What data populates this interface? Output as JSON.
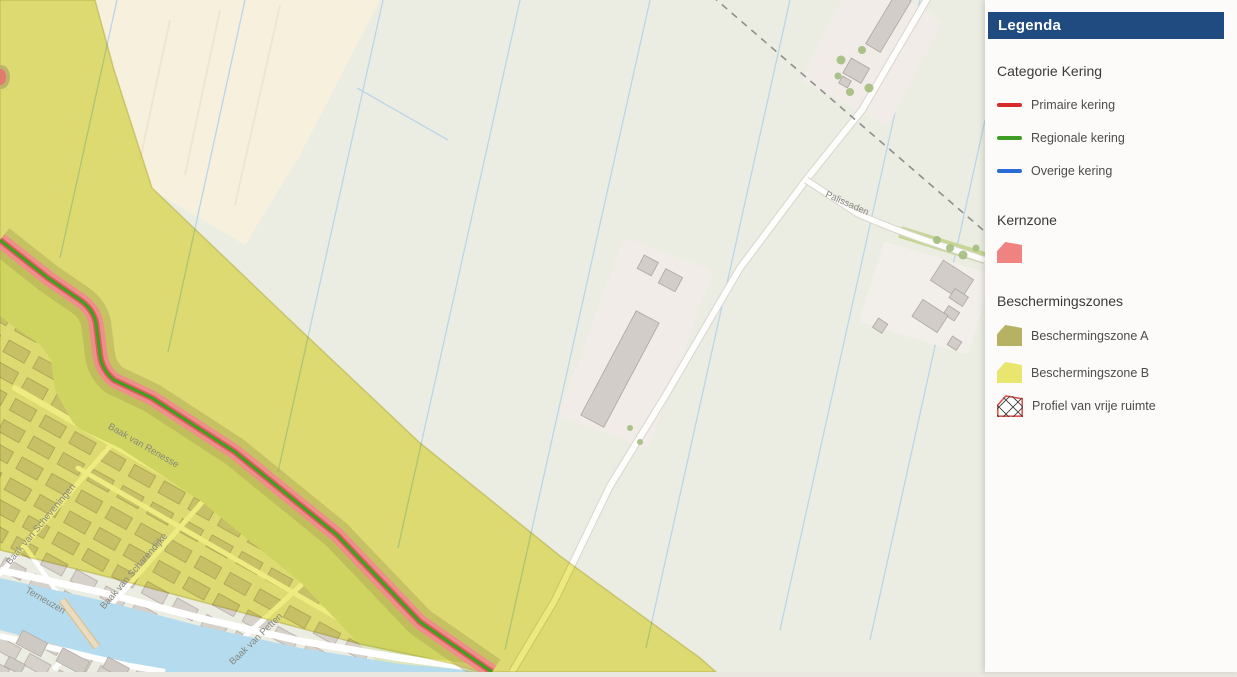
{
  "legend": {
    "title": "Legenda",
    "section_kering": {
      "heading": "Categorie Kering",
      "items": {
        "primaire": "Primaire kering",
        "regionale": "Regionale kering",
        "overige": "Overige kering"
      }
    },
    "section_kernzone": {
      "heading": "Kernzone"
    },
    "section_zones": {
      "heading": "Beschermingszones",
      "items": {
        "zone_a": "Beschermingszone A",
        "zone_b": "Beschermingszone B",
        "profiel": "Profiel van vrije ruimte"
      }
    }
  },
  "map": {
    "labels": {
      "palissaden": "Palissaden",
      "renesse": "Baak van Renesse",
      "scheveningen": "Baak van Scheveningen",
      "scharendijke": "Baak van Scharendijke",
      "petten": "Baak van Petten",
      "terneuzen": "Terneuzen"
    }
  },
  "colors": {
    "legend_header_blue": "#1f4b80",
    "primaire_kering": "#d62b28",
    "regionale_kering": "#3f9e23",
    "overige_kering": "#2a6bd6",
    "kernzone": "#f0837f",
    "beschermingszone_a": "#b7b163",
    "beschermingszone_b": "#e9e66f",
    "profiel_outline": "#e0544b",
    "water": "#b4dcee",
    "field": "#ecede2"
  }
}
